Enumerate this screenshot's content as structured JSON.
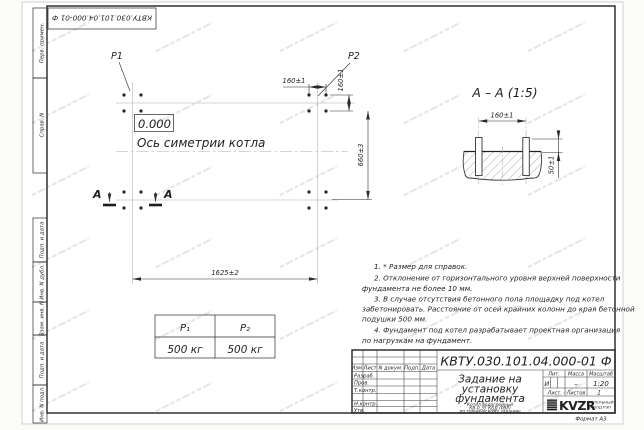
{
  "stamp_top": {
    "text": "КВТУ.030.101.04.000-01  Ф"
  },
  "margins": {
    "labels": [
      "Перв. примен.",
      "Справ. N",
      "Подп. и дата",
      "Инв. N дубл.",
      "Взам. инв. N",
      "Подп. и дата",
      "Инв. N подл."
    ]
  },
  "plan": {
    "p1": "P1",
    "p2": "P2",
    "elevation": "0.000",
    "axis_label": "Ось симетрии котла",
    "dim_width": "1625±2",
    "dim_height": "660±3",
    "dim_bolt_horizontal": "160±1",
    "dim_bolt_vertical": "160±1",
    "section_letter_left": "А",
    "section_letter_right": "А"
  },
  "section_view": {
    "title": "А – А (1:5)",
    "dim_bolt_spacing": "160±1",
    "dim_protrusion": "50±1"
  },
  "load_table": {
    "header_p1": "P₁",
    "header_p2": "P₂",
    "value_p1": "500 кг",
    "value_p2": "500 кг"
  },
  "notes": {
    "lines": [
      "1. * Размер для справок.",
      "2. Отклонение от горизонтального уровня верхней поверхности",
      "фундамента не более 10 мм.",
      "3. В случае отсутствия бетонного пола площадку под котел",
      "забетонировать. Расстояние от осей крайних колонн до края бетонной",
      "подушки 500 мм.",
      "4. Фундамент под котел разрабатывает проектная организация",
      "по нагрузкам на фундамент."
    ]
  },
  "title_block": {
    "doc_number": "КВТУ.030.101.04.000-01  Ф",
    "col_izm": "Изм.",
    "col_list": "Лист",
    "col_ndoc": "N докум.",
    "col_podp": "Подп.",
    "col_data": "Дата",
    "row_razrab": "Разраб.",
    "row_prov": "Пров.",
    "row_tkontr": "Т.контр.",
    "row_nkontr": "Н.контр.",
    "row_utv": "Утв.",
    "title_line1": "Задание на",
    "title_line2": "установку",
    "title_line3": "фундамента",
    "subtitle_line1": "Котел водогрейный",
    "subtitle_line2": "КВ-0,35 КБД (РВР)",
    "subtitle_line3": "по техническому заданию",
    "lit_header": "Лит.",
    "massa_header": "Масса",
    "masshtab_header": "Масштаб",
    "lit_value": "И",
    "massa_value": "–",
    "masshtab_value": "1:20",
    "list_label": "Лист",
    "listov_label": "Листов",
    "listov_value": "1",
    "logo_text": "KVZR",
    "logo_sub1": "КОТЕЛЬНЫЙ",
    "logo_sub2": "ЗАВОД РЭП",
    "format_label": "Формат А3"
  }
}
